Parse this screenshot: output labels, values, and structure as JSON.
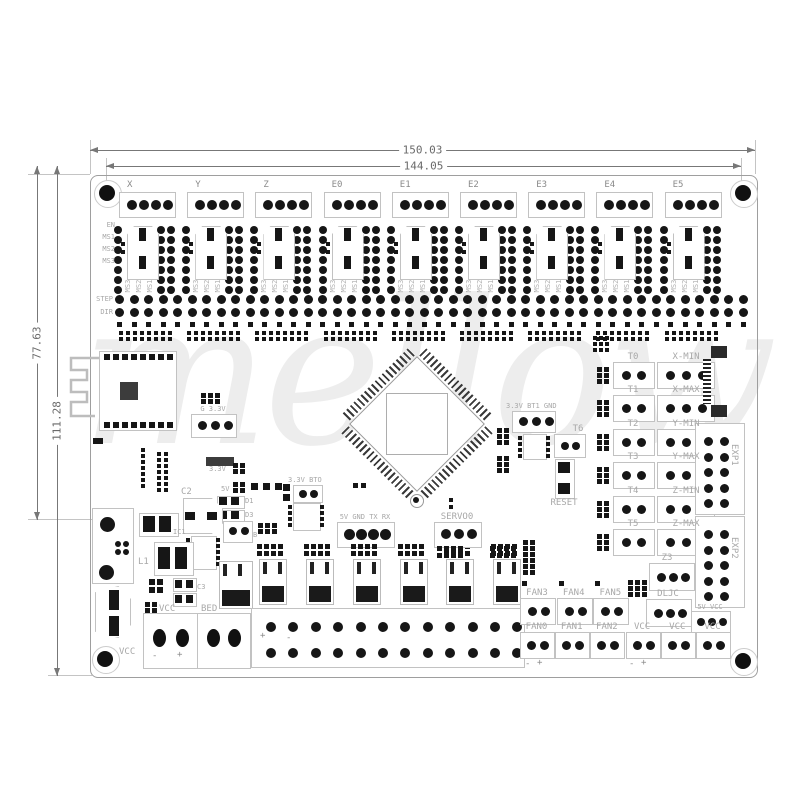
{
  "watermark": "mellow",
  "dimensions": {
    "width_outer": "150.03",
    "width_inner": "144.05",
    "height_left": "77.63",
    "height_full": "111.28"
  },
  "colors": {
    "pad": "#161616",
    "silkscreen": "#a8a8a8",
    "outline": "#c2c2c2",
    "dimension": "#6a6a6a"
  },
  "driver_section": {
    "pin_labels": [
      "EN",
      "MS1",
      "MS2",
      "MS3"
    ],
    "step_label": "STEP",
    "dir_label": "DIR",
    "drivers": [
      "X",
      "Y",
      "Z",
      "E0",
      "E1",
      "E2",
      "E3",
      "E4",
      "E5"
    ],
    "ms": [
      "MS3",
      "MS2",
      "MS1"
    ]
  },
  "io_rows": [
    {
      "t": "T0",
      "e": "X-MIN"
    },
    {
      "t": "T1",
      "e": "X-MAX"
    },
    {
      "t": "T2",
      "e": "Y-MIN"
    },
    {
      "t": "T3",
      "e": "Y-MAX"
    },
    {
      "t": "T4",
      "e": "Z-MIN"
    },
    {
      "t": "T5",
      "e": "Z-MAX"
    }
  ],
  "right_panel": {
    "exp1": "EXP1",
    "exp2": "EXP2",
    "z3": "Z3",
    "dljc": "DLJC",
    "v5vcc": "5V VCC"
  },
  "fans_top": [
    "FAN3",
    "FAN4",
    "FAN5"
  ],
  "fans_bottom": [
    "FAN0",
    "FAN1",
    "FAN2",
    "VCC",
    "VCC",
    "VCC"
  ],
  "terminal_labels": [
    "T5",
    "T4",
    "T3",
    "T2",
    "T1",
    "T0"
  ],
  "polarity": {
    "minus": "-",
    "plus": "+"
  },
  "center": {
    "bt1": "3.3V BT1 GND",
    "t6": "T6",
    "reset": "RESET",
    "servo": "SERVO0",
    "uart": "5V GND TX RX",
    "bt0": "3.3V BTO"
  },
  "left_parts": {
    "g33": "G 3.3V",
    "v33": "3.3V",
    "v5": "5V",
    "c2": "C2",
    "d1": "D1",
    "d3": "D3",
    "b": "B",
    "ic1": "IC1",
    "l1": "L1",
    "c3": "C3",
    "vcc_small": "VCC",
    "bed": "BED",
    "vcc_corner": "VCC"
  }
}
